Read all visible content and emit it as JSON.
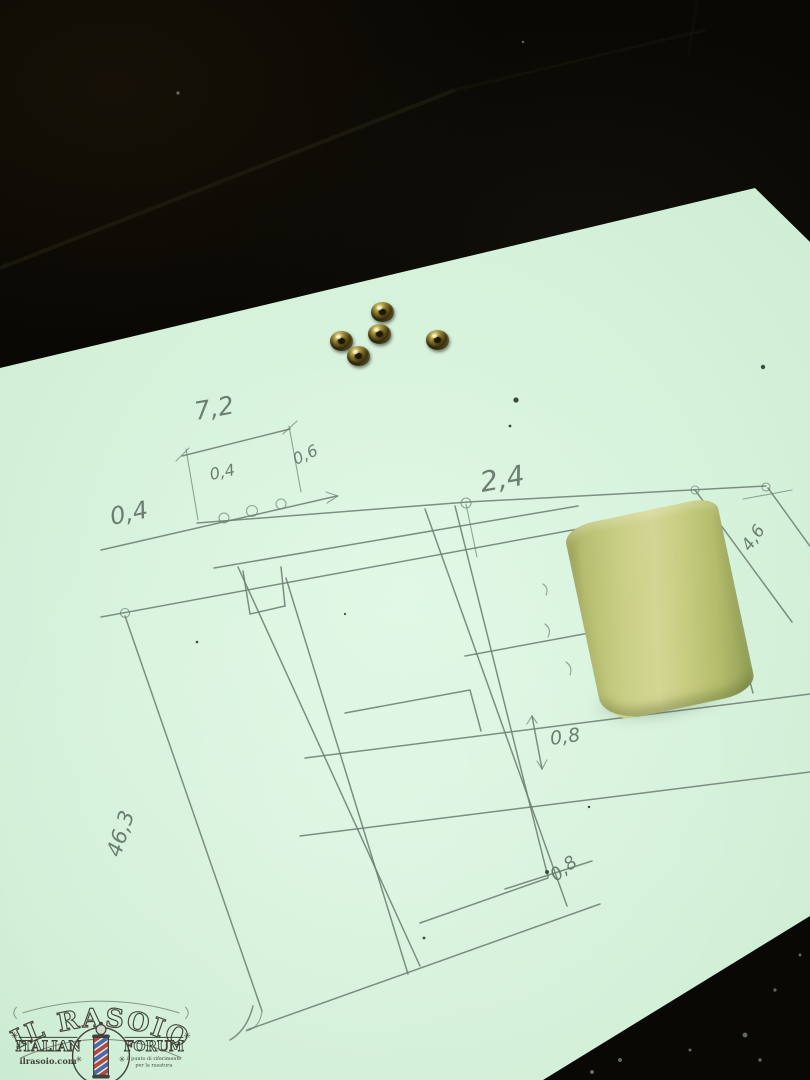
{
  "scene": {
    "table_color": "#0a0906",
    "paper_color": "#cfeed5",
    "tape_color": "#c8cd82",
    "rivet_color": "#a08c34",
    "pencil_color": "#6e8074",
    "rivet_count": 5
  },
  "sketch": {
    "dimensions": [
      {
        "text": "7,2"
      },
      {
        "text": "0,4"
      },
      {
        "text": "0,6"
      },
      {
        "text": "0,4"
      },
      {
        "text": "2,4"
      },
      {
        "text": "0,8"
      },
      {
        "text": "0,8"
      },
      {
        "text": "46,3"
      },
      {
        "text": "6"
      },
      {
        "text": "4,6"
      }
    ]
  },
  "watermark": {
    "title": "IL RASOIO",
    "ornament": "✳",
    "left_word": "ITALIAN",
    "right_word": "FORUM",
    "url": "ilrasoio.com",
    "tagline_line1": "il punto di riferimento",
    "tagline_line2": "per la rasatura"
  }
}
